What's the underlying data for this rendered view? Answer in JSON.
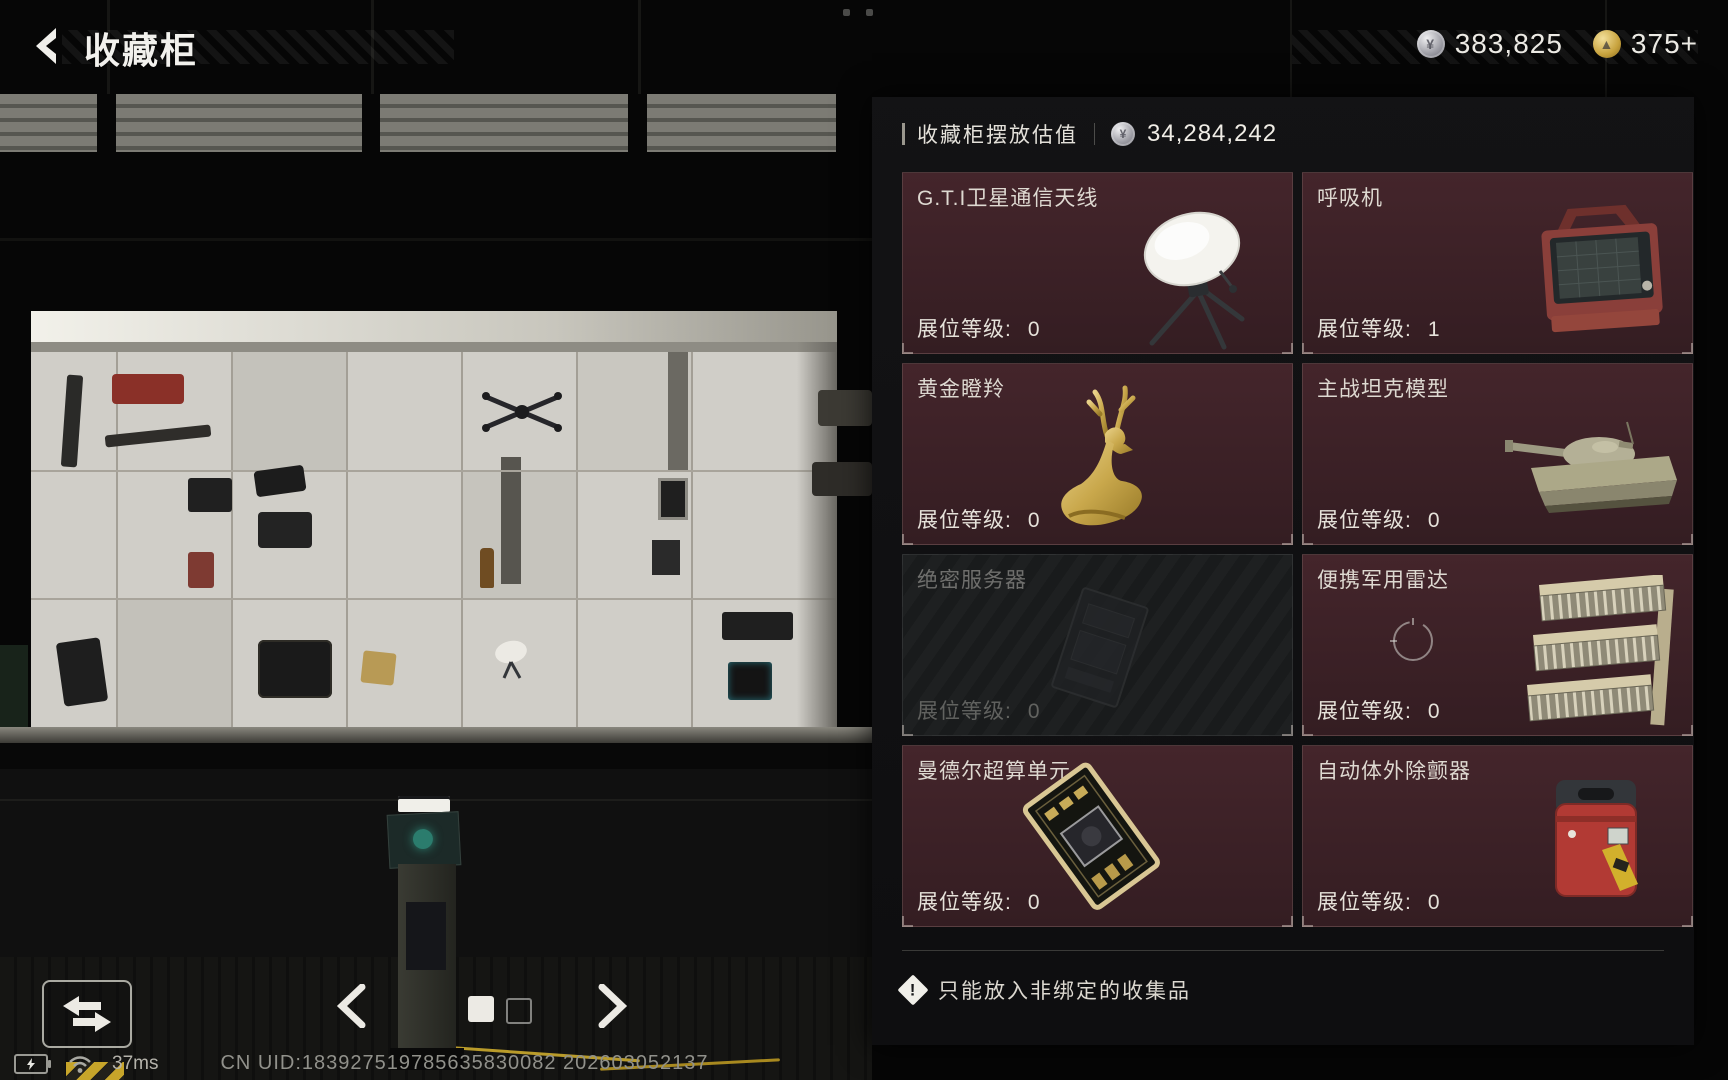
{
  "header": {
    "title": "收藏柜",
    "currencies": [
      {
        "icon": "silver-coin",
        "value": "383,825"
      },
      {
        "icon": "gold-coin",
        "value": "375+"
      }
    ]
  },
  "panel": {
    "title": "收藏柜摆放估值",
    "total_value": "34,284,242",
    "level_label": "展位等级:",
    "items": [
      {
        "name": "G.T.I卫星通信天线",
        "level": "0",
        "image": "satellite-dish",
        "disabled": false
      },
      {
        "name": "呼吸机",
        "level": "1",
        "image": "ventilator",
        "disabled": false
      },
      {
        "name": "黄金瞪羚",
        "level": "0",
        "image": "golden-gazelle",
        "disabled": false
      },
      {
        "name": "主战坦克模型",
        "level": "0",
        "image": "tank-model",
        "disabled": false
      },
      {
        "name": "绝密服务器",
        "level": "0",
        "image": "secret-server",
        "disabled": true
      },
      {
        "name": "便携军用雷达",
        "level": "0",
        "image": "military-radar",
        "disabled": false
      },
      {
        "name": "曼德尔超算单元",
        "level": "0",
        "image": "supercomputer-unit",
        "disabled": false
      },
      {
        "name": "自动体外除颤器",
        "level": "0",
        "image": "defibrillator",
        "disabled": false
      }
    ],
    "warning_icon": "!",
    "warning": "只能放入非绑定的收集品"
  },
  "statusbar": {
    "ping": "37ms",
    "uid": "CN UID:183927519785635830082 202603052137"
  }
}
